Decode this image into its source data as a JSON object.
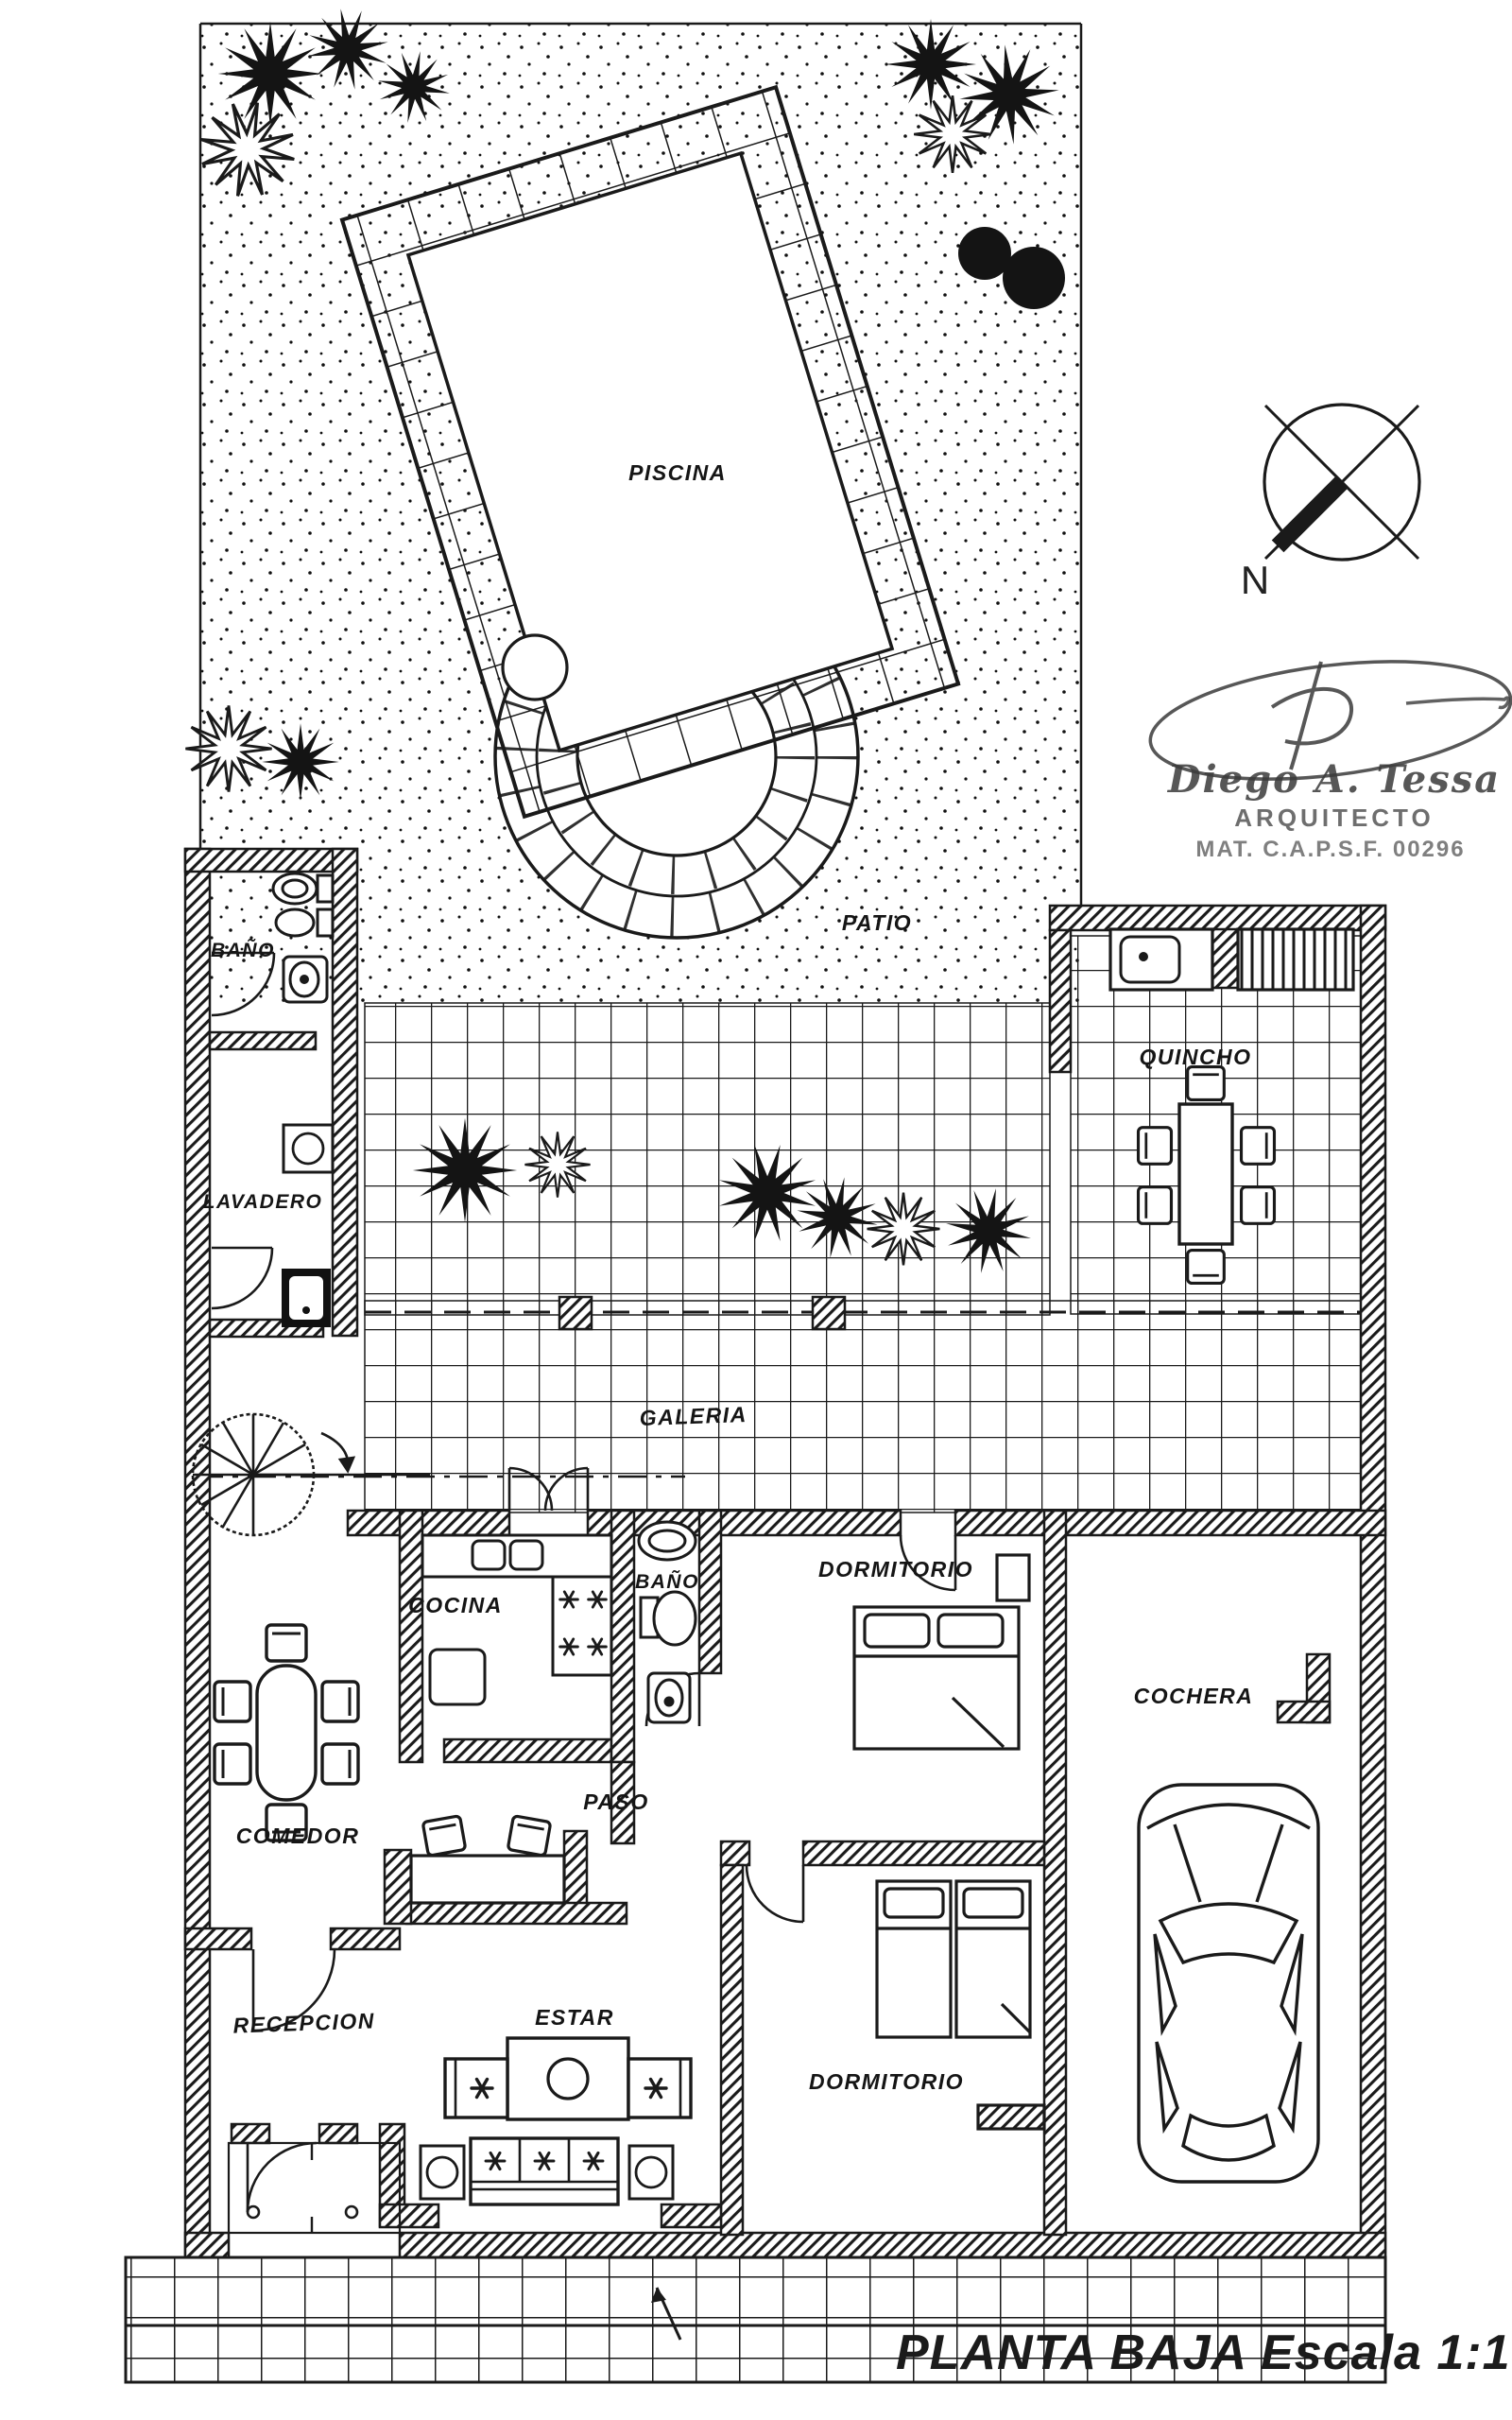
{
  "title_block": {
    "title": "PLANTA BAJA",
    "scale": "Escala 1:100"
  },
  "compass": {
    "north_label": "N"
  },
  "architect": {
    "signature_name": "Diego A. Tessa",
    "profession": "ARQUITECTO",
    "registration": "MAT. C.A.P.S.F. 00296"
  },
  "rooms": {
    "piscina": "PISCINA",
    "patio": "PATIO",
    "quincho": "QUINCHO",
    "bano_servicio": "BAÑO",
    "lavadero": "LAVADERO",
    "galeria": "GALERIA",
    "cocina": "COCINA",
    "bano": "BAÑO",
    "dormitorio_1": "DORMITORIO",
    "cochera": "COCHERA",
    "comedor": "COMEDOR",
    "paso": "PASO",
    "recepcion": "RECEPCION",
    "estar": "ESTAR",
    "dormitorio_2": "DORMITORIO"
  },
  "colors": {
    "ink": "#1a1a1a",
    "paper": "#ffffff"
  }
}
